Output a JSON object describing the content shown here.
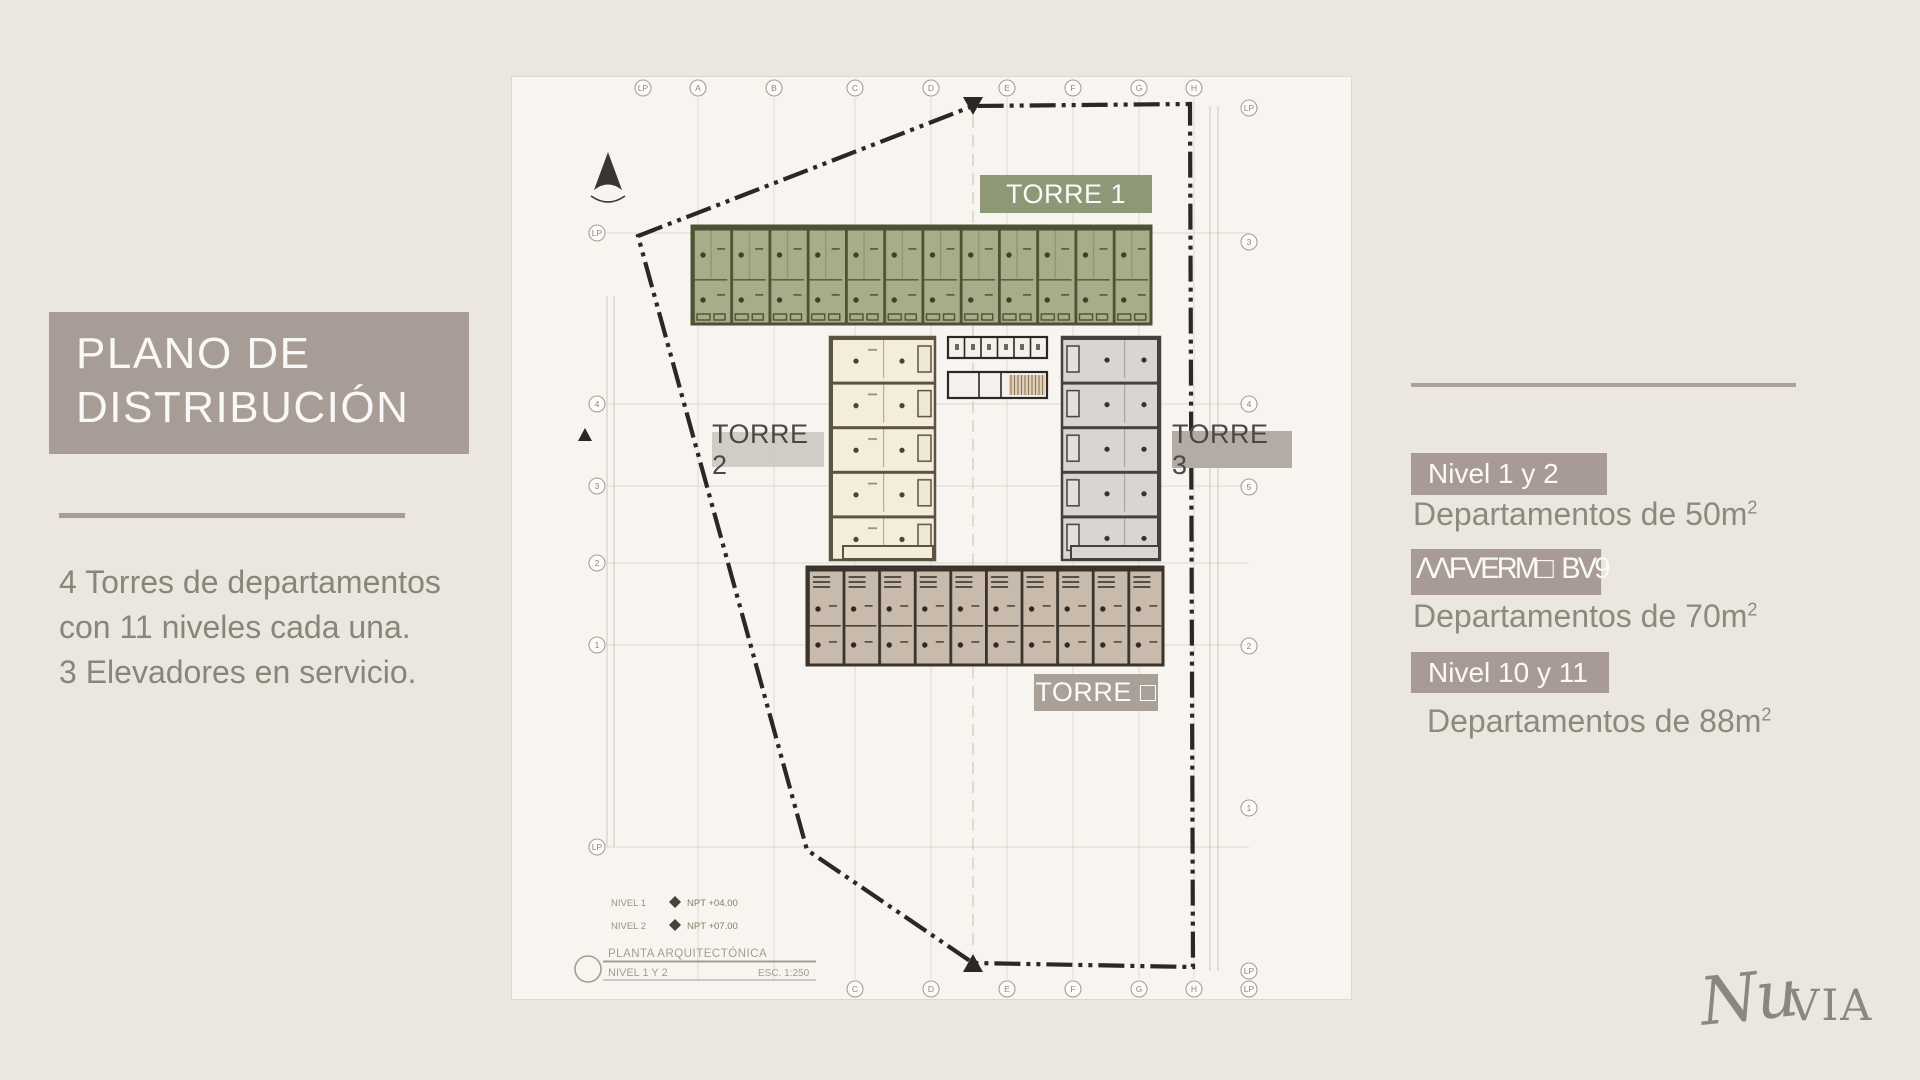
{
  "slide": {
    "title": "PLANO DE DISTRIBUCIÓN",
    "body_lines": [
      "4 Torres de departamentos",
      "con 11 niveles cada una.",
      "3 Elevadores en servicio."
    ]
  },
  "plan": {
    "labels": {
      "torre1": "TORRE 1",
      "torre2": "TORRE 2",
      "torre3": "TORRE 3",
      "torre4": "TORRE □"
    },
    "grid": {
      "top": [
        "LP",
        "A",
        "B",
        "C",
        "D",
        "E",
        "F",
        "G",
        "H"
      ],
      "top_right": "LP",
      "left": [
        "LP",
        "4",
        "3",
        "2",
        "1",
        "LP"
      ],
      "right": [
        "3",
        "4",
        "5",
        "2",
        "1",
        "LP"
      ],
      "bottom": [
        "C",
        "D",
        "E",
        "F",
        "G",
        "H",
        "LP"
      ]
    },
    "levels": [
      {
        "name": "NIVEL 1",
        "npt": "NPT +04.00"
      },
      {
        "name": "NIVEL 2",
        "npt": "NPT +07.00"
      }
    ],
    "titleblock": {
      "title": "PLANTA ARQUITECTÓNICA",
      "subtitle": "NIVEL 1 Y 2",
      "scale": "ESC. 1:250"
    }
  },
  "legend": {
    "items": [
      {
        "badge": "Nivel 1 y 2",
        "desc": "Departamentos de 50m",
        "sup": "2"
      },
      {
        "badge": "ΛΛFVERM□  BV9",
        "desc": "Departamentos de 70m",
        "sup": "2"
      },
      {
        "badge": "Nivel 10 y 11",
        "desc": "Departamentos de 88m",
        "sup": "2"
      }
    ]
  },
  "logo": {
    "script": "Nu",
    "serif": "VIA"
  },
  "colors": {
    "background": "#ECE6E1",
    "paper": "#F8F5F1",
    "accent_taupe": "#A79C96",
    "sage_green": "#8E9877",
    "body_text": "#8A8677",
    "boundary": "#2B2722",
    "tower_green_fill": "#A7AD89",
    "tower_cream_fill": "#F4EDDB",
    "tower_gray_fill": "#D9D5D1",
    "tower_brown_fill": "#C8BBAC"
  }
}
